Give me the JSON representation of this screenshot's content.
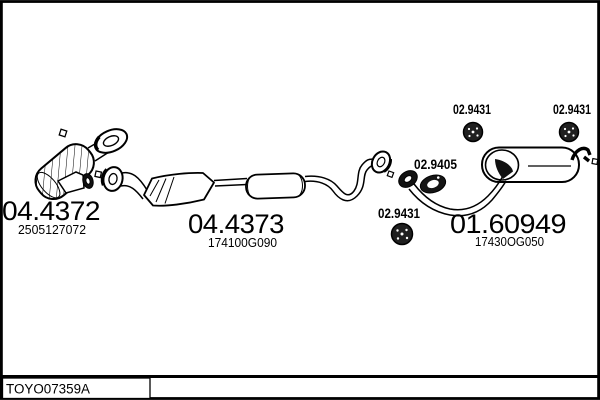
{
  "page": {
    "background": "#ffffff",
    "line_color": "#000000"
  },
  "parts": {
    "front_catalyst": {
      "part_number": "04.4372",
      "oe_number": "2505127072"
    },
    "middle_section": {
      "part_number": "04.4373",
      "oe_number": "174100G090"
    },
    "rear_muffler": {
      "part_number": "01.60949",
      "oe_number": "17430OG050"
    },
    "mount_ring_top_left": {
      "part_number": "02.9431"
    },
    "mount_ring_top_right": {
      "part_number": "02.9431"
    },
    "mount_ring_bottom": {
      "part_number": "02.9431"
    },
    "gasket": {
      "part_number": "02.9405"
    }
  },
  "footer": {
    "drawing_code": "TOYO07359A"
  }
}
